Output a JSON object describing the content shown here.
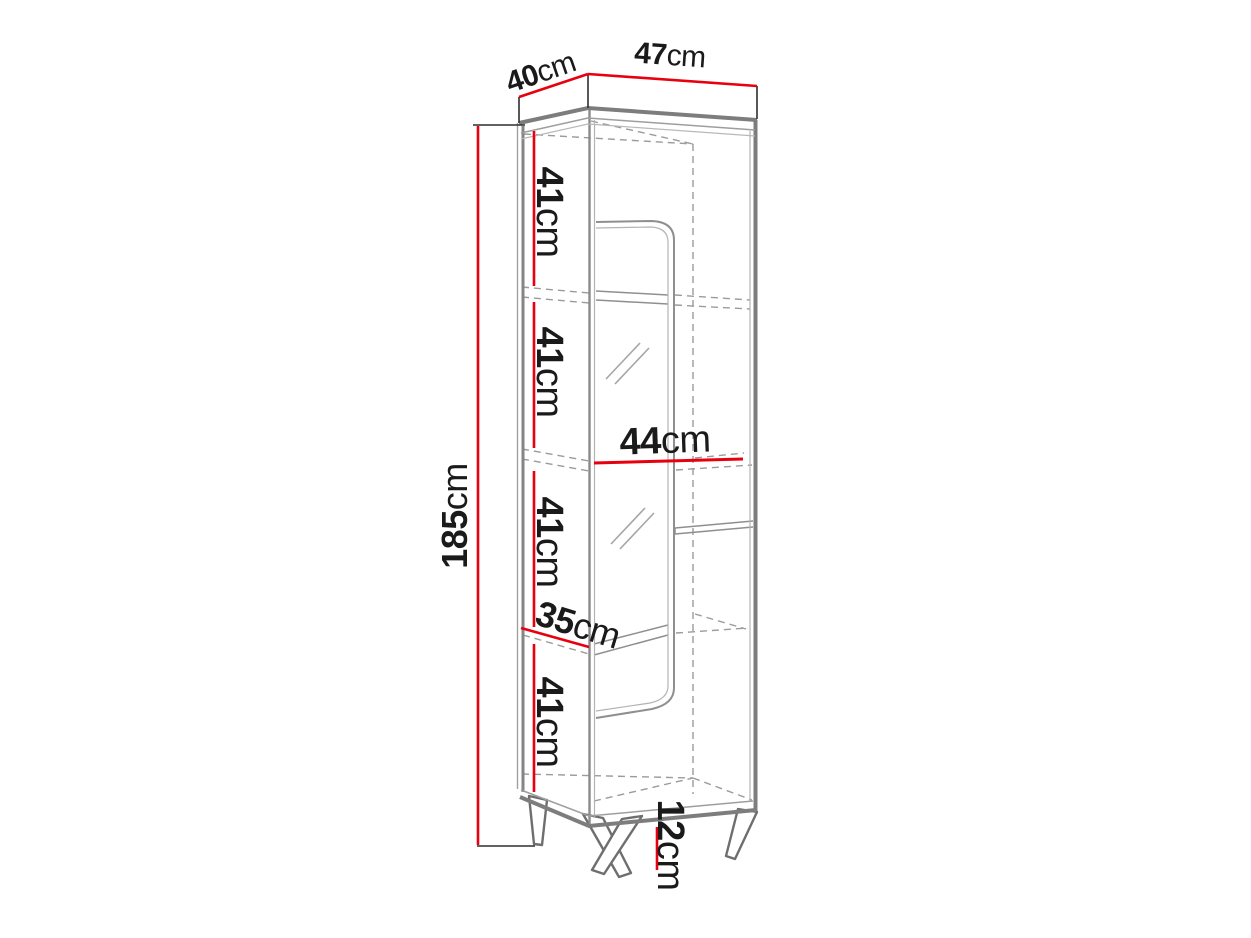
{
  "diagram": {
    "dimensions": {
      "depth": {
        "value": "40",
        "unit": "cm"
      },
      "width": {
        "value": "47",
        "unit": "cm"
      },
      "height_total": {
        "value": "185",
        "unit": "cm"
      },
      "section_1": {
        "value": "41",
        "unit": "cm"
      },
      "section_2": {
        "value": "41",
        "unit": "cm"
      },
      "shelf_width": {
        "value": "44",
        "unit": "cm"
      },
      "section_3": {
        "value": "41",
        "unit": "cm"
      },
      "interior_depth": {
        "value": "35",
        "unit": "cm"
      },
      "section_4": {
        "value": "41",
        "unit": "cm"
      },
      "leg_height": {
        "value": "12",
        "unit": "cm"
      }
    },
    "colors": {
      "dimension_red": "#e8000e",
      "outline_gray": "#7d7d7d",
      "text_black": "#1a1a1a"
    }
  }
}
